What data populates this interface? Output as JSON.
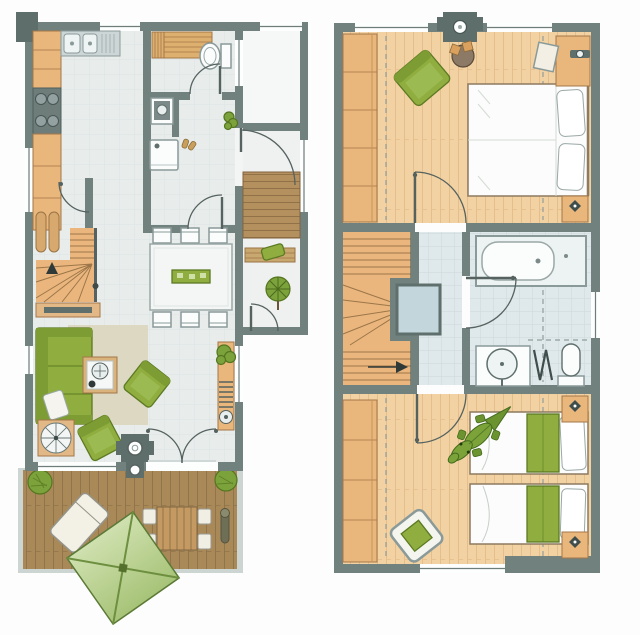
{
  "document": {
    "type": "holiday-house floor plan, two storeys side by side",
    "ground_floor_position": "left",
    "upper_floor_position": "right"
  },
  "palette": {
    "wall": "#71817e",
    "wall_dark": "#5e6e6b",
    "ground_floor_tiles": "#e8edec",
    "bath_tiles": "#dfe8ea",
    "cabinet_wood": "#e9b77c",
    "stair_wood": "#eab67e",
    "terrace_deck": "#aa8959",
    "porch_deck": "#b3905e",
    "upper_wood_floor": "#f2d2a2",
    "furniture_green": "#8fae3f",
    "parasol_green_light": "#e3efcb",
    "parasol_green_dark": "#93b55c",
    "rug_beige": "#dcd8c2",
    "skylight_blue": "#c3d6dc",
    "fixture_white": "#fbfdfd"
  },
  "ground_floor": {
    "label": "Ground floor plan",
    "rooms": [
      {
        "id": "kitchen",
        "label": "Kitchen",
        "items": [
          "kitchen counter",
          "cooktop with four burners",
          "double sink with drainer"
        ]
      },
      {
        "id": "sauna-bath",
        "label": "Shower room with sauna",
        "items": [
          "sauna bench",
          "toilet",
          "washbasin",
          "washing machine",
          "pair of shoes"
        ]
      },
      {
        "id": "hallway",
        "label": "Hallway",
        "items": [
          "wall plant",
          "entrance door"
        ]
      },
      {
        "id": "dining",
        "label": "Dining area",
        "items": [
          "dining table",
          "six chairs",
          "green table runner"
        ]
      },
      {
        "id": "stairs",
        "label": "Staircase corner",
        "items": [
          "winder staircase",
          "handrail",
          "radiator",
          "sideboard",
          "up arrow"
        ]
      },
      {
        "id": "living",
        "label": "Living room",
        "items": [
          "green sofa",
          "white cushion",
          "beige rug",
          "coffee table",
          "two green armchairs",
          "round side table",
          "wood-burning stove with flue",
          "shelf with plant and radiator",
          "french doors to terrace"
        ]
      },
      {
        "id": "porch",
        "label": "Entrance porch",
        "items": [
          "wooden deck",
          "bench with green cushion",
          "small tree",
          "garden door"
        ]
      },
      {
        "id": "terrace",
        "label": "Terrace",
        "items": [
          "wooden deck",
          "green parasol",
          "sun lounger",
          "slatted outdoor table",
          "four seat cushions",
          "two shrubs",
          "patio heater"
        ]
      }
    ]
  },
  "upper_floor": {
    "label": "Upper floor plan",
    "rooms": [
      {
        "id": "bedroom-1",
        "label": "Bedroom with double bed",
        "items": [
          "double bed",
          "two pillows",
          "wardrobe wall",
          "green armchair",
          "round table with two stools",
          "dressing table",
          "stool",
          "mirror",
          "nightstand with lamp",
          "chimney"
        ]
      },
      {
        "id": "landing",
        "label": "Landing",
        "items": [
          "winder staircase",
          "up arrow",
          "skylight"
        ]
      },
      {
        "id": "bathroom",
        "label": "Bathroom",
        "items": [
          "bathtub",
          "washbasin vanity",
          "toilet",
          "towel radiator",
          "window"
        ]
      },
      {
        "id": "bedroom-2",
        "label": "Bedroom with two single beds",
        "items": [
          "two single beds with green blankets",
          "wardrobe wall",
          "toy crocodile",
          "chair with green cushion",
          "two nightstands with lamps"
        ]
      }
    ]
  }
}
